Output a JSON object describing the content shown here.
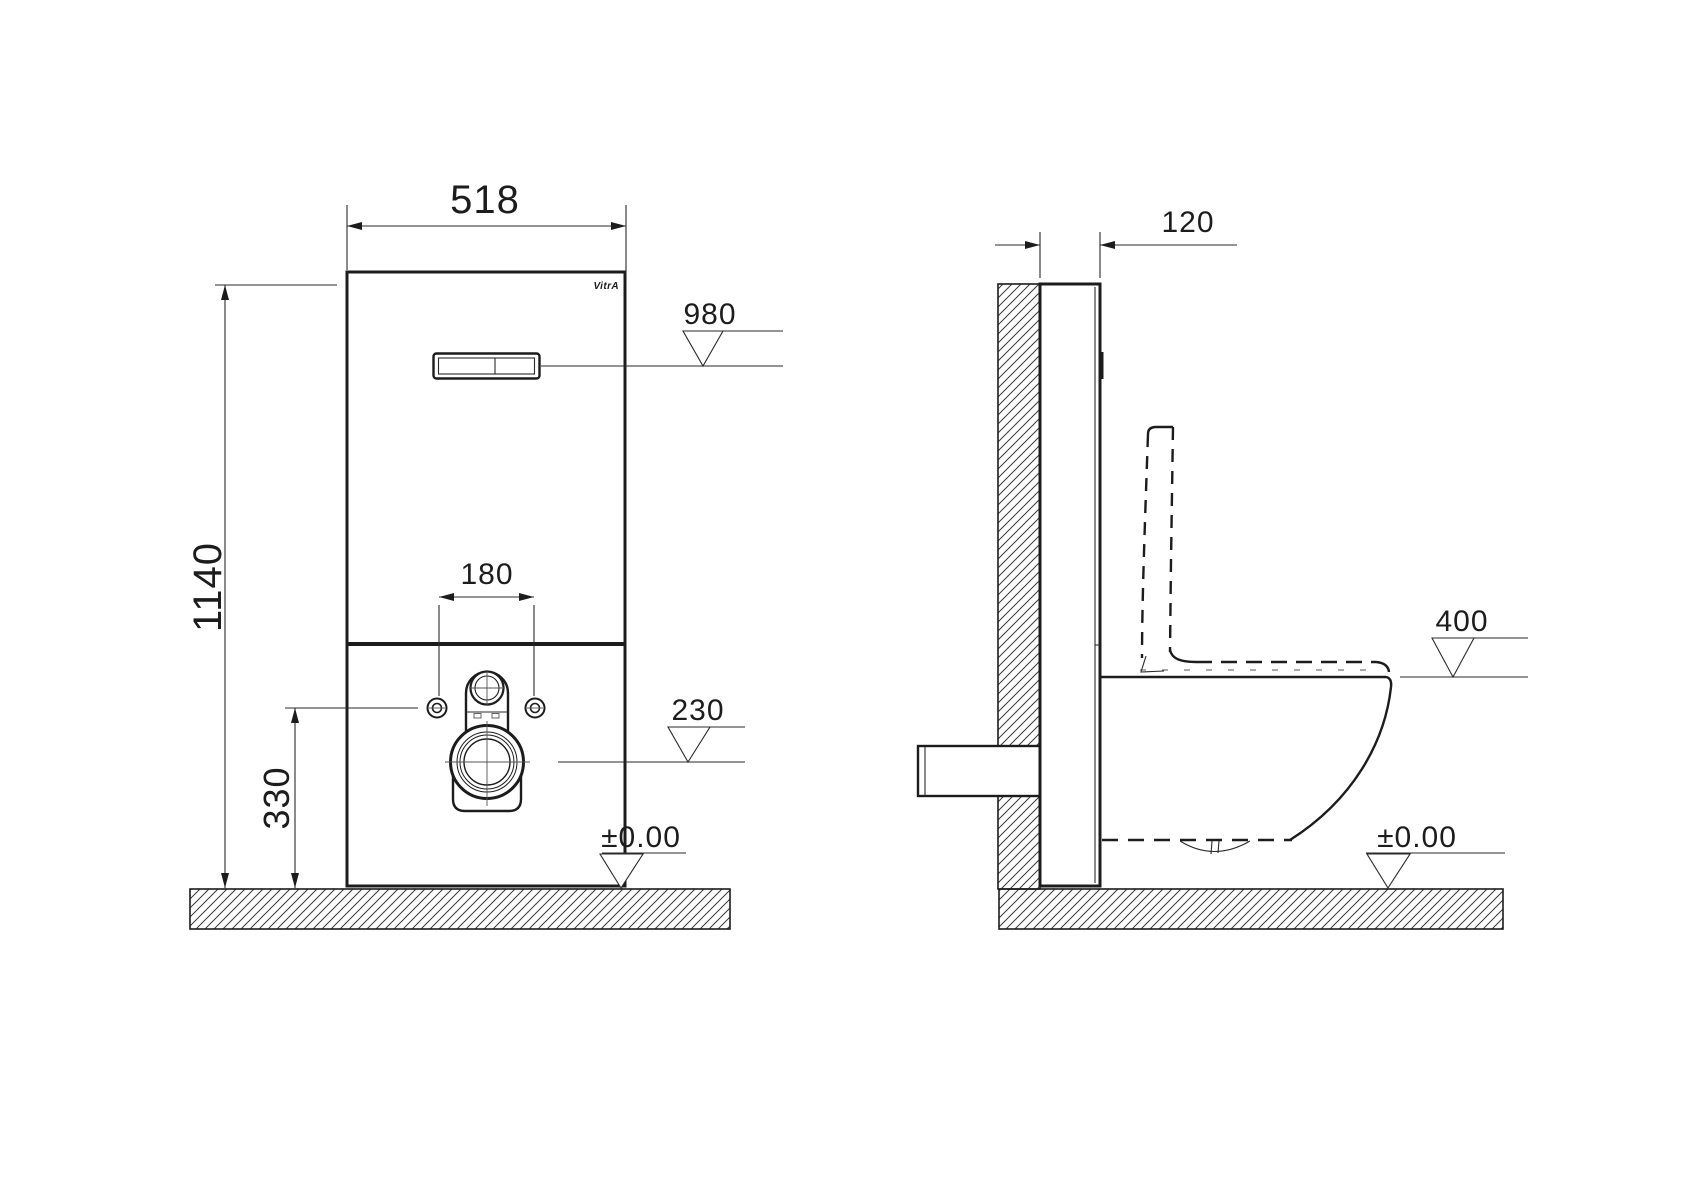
{
  "brand": "VitrA",
  "front_view": {
    "width": "518",
    "height": "1140",
    "flush_plate_height": "980",
    "bolt_spacing": "180",
    "outlet_height": "230",
    "bolt_height": "330",
    "floor_level": "±0.00"
  },
  "side_view": {
    "depth": "120",
    "rim_height": "400",
    "floor_level": "±0.00"
  },
  "colors": {
    "line": "#1c1c1c",
    "background": "#ffffff"
  }
}
